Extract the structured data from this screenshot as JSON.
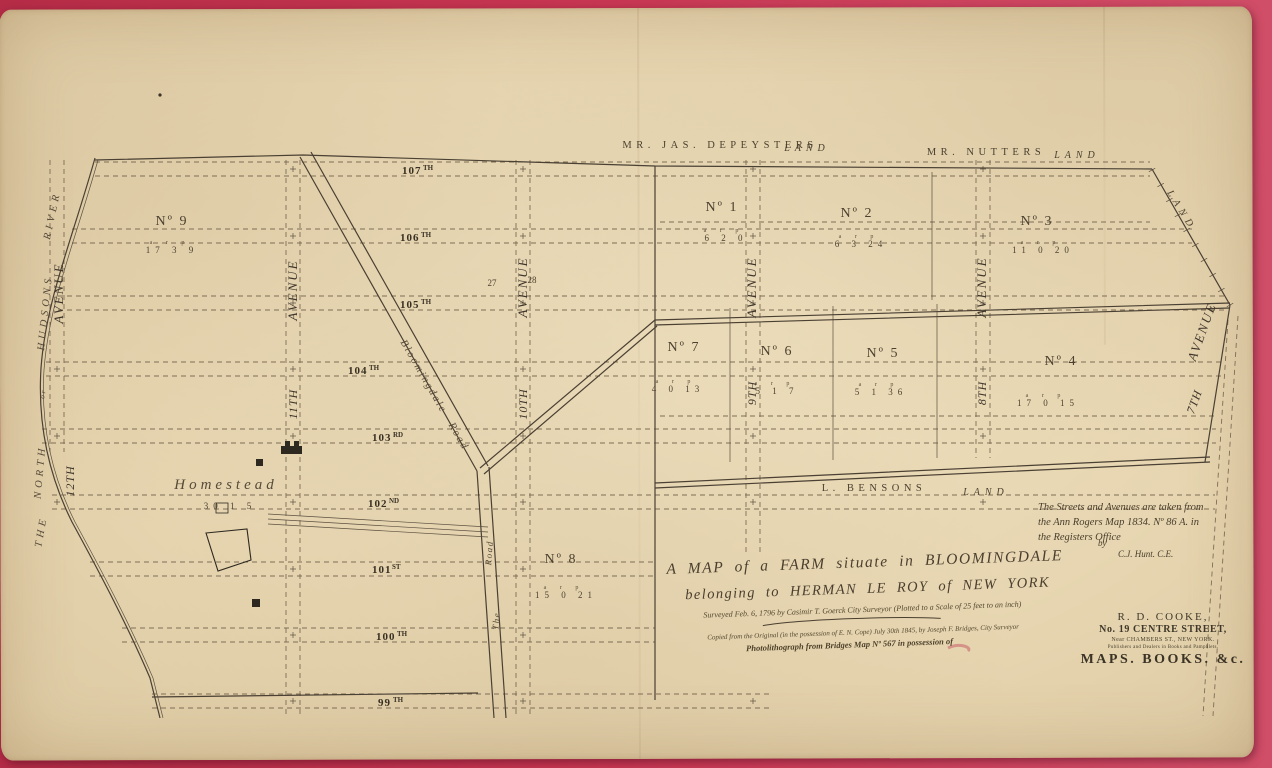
{
  "palette": {
    "background_red": "#c73652",
    "paper": "#e9d9b6",
    "ink": "#473c2d",
    "red_mark": "#c24458"
  },
  "map": {
    "streets": [
      {
        "num": "107",
        "suf": "TH"
      },
      {
        "num": "106",
        "suf": "TH"
      },
      {
        "num": "105",
        "suf": "TH"
      },
      {
        "num": "104",
        "suf": "TH"
      },
      {
        "num": "103",
        "suf": "RD"
      },
      {
        "num": "102",
        "suf": "ND"
      },
      {
        "num": "101",
        "suf": "ST"
      },
      {
        "num": "100",
        "suf": "TH"
      },
      {
        "num": "99",
        "suf": "TH"
      }
    ],
    "avenue_word": "AVENUE",
    "avenue_ordinals": [
      "12TH",
      "11TH",
      "10TH",
      "9TH",
      "8TH",
      "7TH"
    ],
    "arp_header": "a r p",
    "plots": [
      {
        "no": "Nº 9",
        "arp": "17 3 9"
      },
      {
        "no": "Nº 1",
        "arp": "6 2 0"
      },
      {
        "no": "Nº 2",
        "arp": "6 3 24"
      },
      {
        "no": "Nº 3",
        "arp": "11 0 20"
      },
      {
        "no": "Nº 7",
        "arp": "4 0 13"
      },
      {
        "no": "Nº 6",
        "arp": "5 1 7"
      },
      {
        "no": "Nº 5",
        "arp": "5 1 36"
      },
      {
        "no": "Nº 4",
        "arp": "17 0 15"
      },
      {
        "no": "Nº 8",
        "arp": "15 0 21"
      }
    ],
    "homestead": {
      "label": "Homestead",
      "arp": "30 1 5"
    },
    "lot_numbers": [
      "27",
      "28"
    ],
    "lands": {
      "depeyster_name": "MR. JAS. DEPEYSTERS",
      "nutter_name": "MR. NUTTERS",
      "benson_name": "L. BENSONS",
      "land_word": "LAND"
    },
    "river": {
      "the": "THE",
      "north": "NORTH",
      "or": "or",
      "hudsons": "HUDSONS",
      "river": "RIVER"
    },
    "roads": {
      "bloomingdale": "Bloomingdale",
      "road": "Road",
      "the": "The"
    }
  },
  "title_block": {
    "line1": "A MAP of a FARM situate in BLOOMINGDALE",
    "line2": "belonging to HERMAN LE ROY of NEW YORK",
    "line3": "Surveyed Feb. 6, 1796 by Casimir T. Goerck City Surveyor (Plotted to a Scale of 25 feet to an inch)",
    "line4": "Copied from the Original (in the possession of E. N. Cope) July 30th 1845, by Joseph F. Bridges, City Surveyor",
    "line5": "Photolithograph from Bridges Map Nº 567 in possession of"
  },
  "survey_note": {
    "line1": "The Streets and Avenues are taken from",
    "line2": "the Ann Rogers Map 1834. Nº 86 A. in",
    "line3": "the Registers Office",
    "by": "by",
    "signature": "C.J. Hunt. C.E."
  },
  "publisher": {
    "name": "R. D. COOKE,",
    "address": "No. 19 CENTRE STREET,",
    "address2": "Near CHAMBERS ST., NEW YORK.",
    "line": "Publishers and Dealers in Books and Pamphlets.",
    "products": "MAPS. BOOKS. &c."
  }
}
